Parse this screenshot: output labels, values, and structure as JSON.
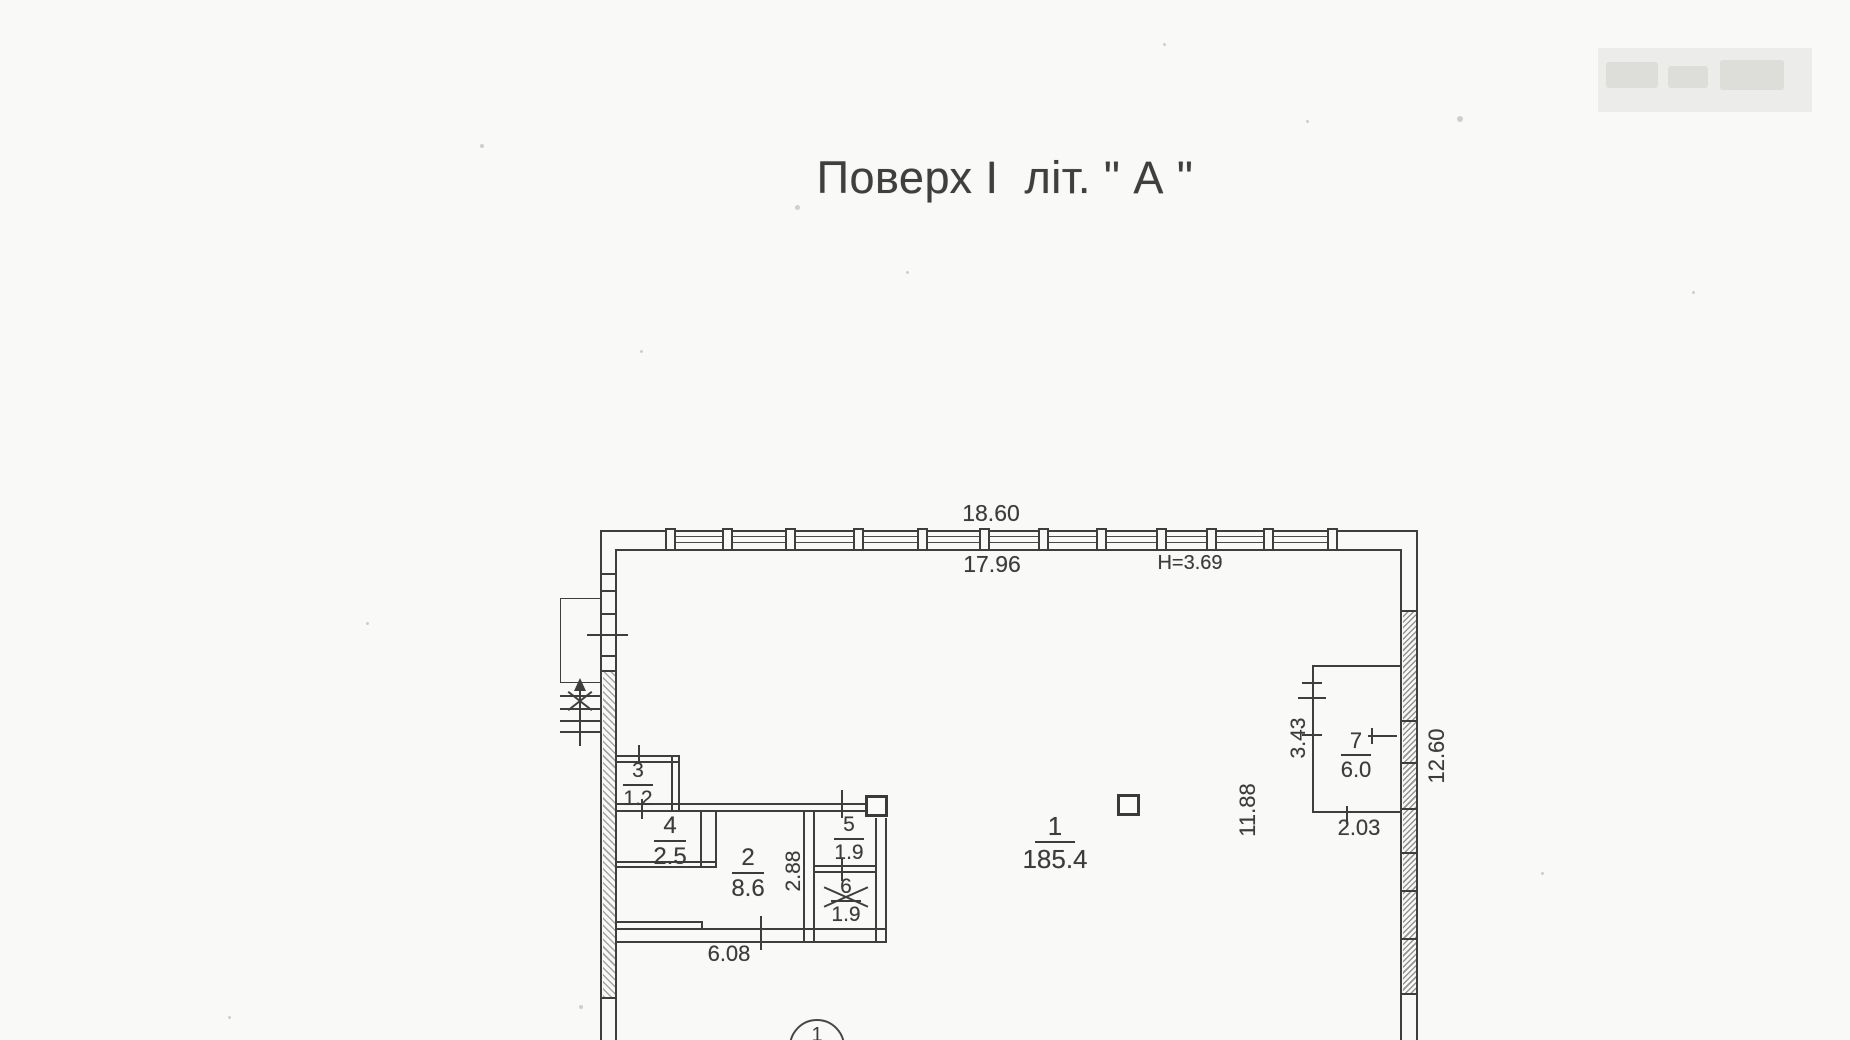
{
  "title": "Поверх І  літ. \" А \"",
  "dimensions": {
    "top_width_outer": "18.60",
    "top_width_inner": "17.96",
    "ceiling_height": "H=3.69",
    "bottom_left_width": "6.08",
    "room2_depth": "2.88",
    "hall_depth": "11.88",
    "right_wall_height": "12.60",
    "room7_depth": "3.43",
    "room7_width": "2.03"
  },
  "rooms": {
    "r1": {
      "number": "1",
      "area": "185.4"
    },
    "r2": {
      "number": "2",
      "area": "8.6"
    },
    "r3": {
      "number": "3",
      "area": "1.2"
    },
    "r4": {
      "number": "4",
      "area": "2.5"
    },
    "r5": {
      "number": "5",
      "area": "1.9"
    },
    "r6": {
      "number": "6",
      "area": "1.9"
    },
    "r7": {
      "number": "7",
      "area": "6.0"
    }
  },
  "axis": {
    "marker": "1"
  }
}
